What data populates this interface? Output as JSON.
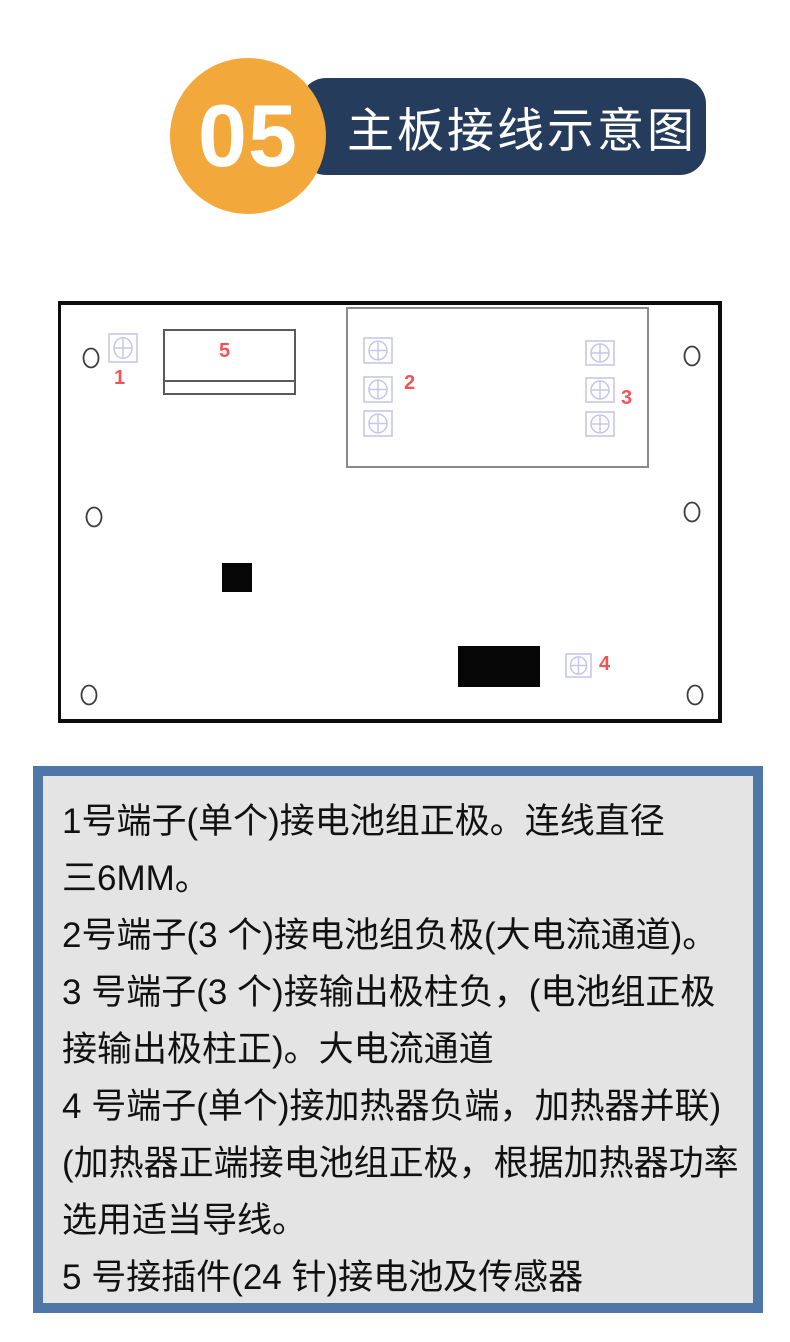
{
  "header": {
    "badge": "05",
    "title": "主板接线示意图",
    "badge_color": "#f3a83c",
    "banner_color": "#253c5c"
  },
  "board": {
    "label_color": "#f05555",
    "terminal_color": "#c6c6e6",
    "hole_color": "#3d3d3d",
    "terminals": [
      {
        "x": 47,
        "y": 28,
        "w": 30,
        "h": 30
      },
      {
        "x": 302,
        "y": 32,
        "w": 30,
        "h": 27
      },
      {
        "x": 302,
        "y": 71,
        "w": 30,
        "h": 27
      },
      {
        "x": 302,
        "y": 105,
        "w": 30,
        "h": 27
      },
      {
        "x": 524,
        "y": 35,
        "w": 30,
        "h": 26
      },
      {
        "x": 524,
        "y": 72,
        "w": 30,
        "h": 26
      },
      {
        "x": 524,
        "y": 106,
        "w": 30,
        "h": 26
      },
      {
        "x": 504,
        "y": 348,
        "w": 27,
        "h": 25
      }
    ],
    "labels": [
      {
        "text": "1",
        "x": 53,
        "y": 63
      },
      {
        "text": "2",
        "x": 343,
        "y": 68
      },
      {
        "text": "3",
        "x": 560,
        "y": 83
      },
      {
        "text": "4",
        "x": 538,
        "y": 349
      },
      {
        "text": "5",
        "x": 158,
        "y": 36
      }
    ],
    "holes": [
      {
        "cx": 30,
        "cy": 53
      },
      {
        "cx": 631,
        "cy": 51
      },
      {
        "cx": 33,
        "cy": 212
      },
      {
        "cx": 631,
        "cy": 207
      },
      {
        "cx": 28,
        "cy": 390
      },
      {
        "cx": 634,
        "cy": 390
      }
    ],
    "connector": {
      "x": 102,
      "y": 24,
      "w": 133,
      "h": 66,
      "divider_y": 49
    },
    "inner_rect": {
      "x": 285,
      "y": 2,
      "w": 303,
      "h": 161
    },
    "filled_blocks": [
      {
        "x": 161,
        "y": 258,
        "w": 30,
        "h": 29
      },
      {
        "x": 397,
        "y": 341,
        "w": 82,
        "h": 41
      }
    ]
  },
  "notes": {
    "lines": [
      "1号端子(单个)接电池组正极。连线直径",
      "三6MM。",
      "2号端子(3 个)接电池组负极(大电流通道)。",
      "3 号端子(3 个)接输出极柱负，(电池组正极",
      "接输出极柱正)。大电流通道",
      "4 号端子(单个)接加热器负端，加热器并联)",
      "(加热器正端接电池组正极，根据加热器功率",
      "选用适当导线。",
      "5 号接插件(24 针)接电池及传感器"
    ],
    "panel_border_color": "#4e76a6",
    "panel_bg_color": "#e4e4e4"
  }
}
